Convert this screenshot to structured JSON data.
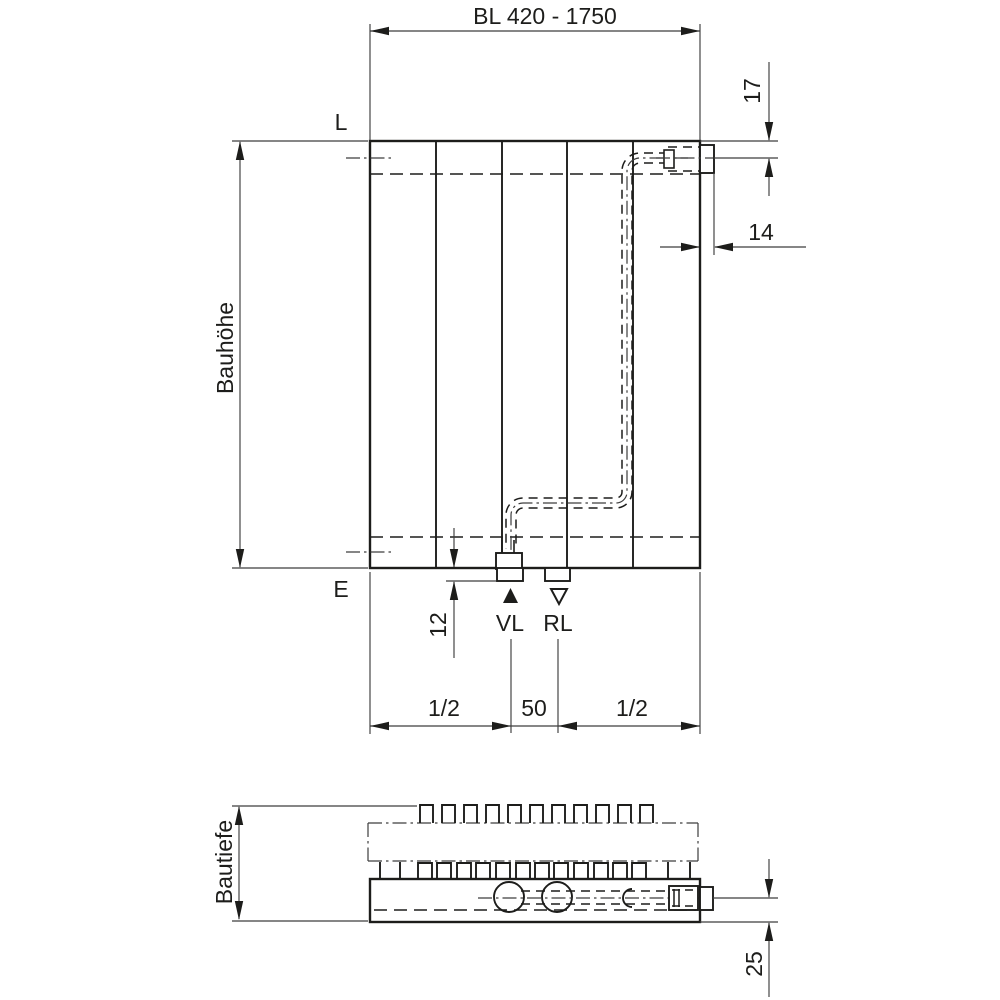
{
  "colors": {
    "ink": "#1d1d1b",
    "dimension_lines": "#3d3d3d",
    "background": "#ffffff"
  },
  "front_view": {
    "overall_length_dim": "BL 420 - 1750",
    "top_offset_dim": "17",
    "side_offset_dim": "14",
    "height_label": "Bauhöhe",
    "label_l": "L",
    "label_e": "E",
    "stub_depth_dim": "12",
    "supply_label": "VL",
    "return_label": "RL",
    "bottom_left_dim": "1/2",
    "bottom_center_dim": "50",
    "bottom_right_dim": "1/2"
  },
  "top_view": {
    "depth_label": "Bautiefe",
    "rear_offset_dim": "25"
  }
}
